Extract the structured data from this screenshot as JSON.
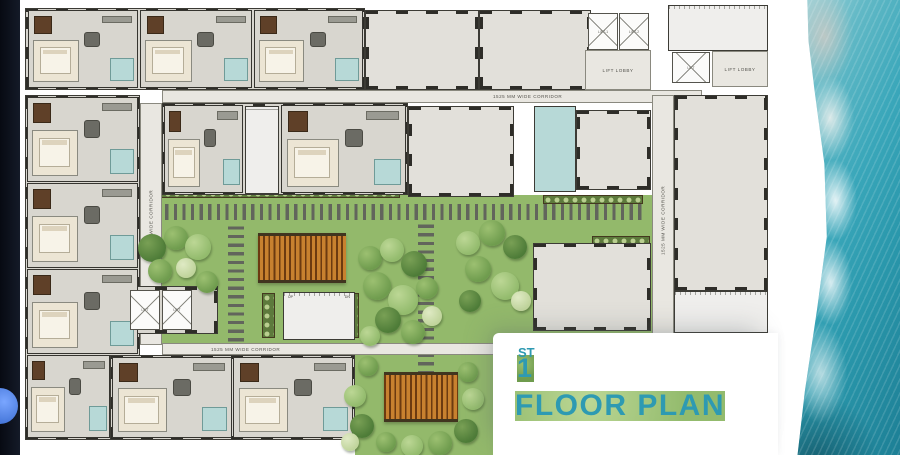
{
  "title": {
    "number": "1",
    "suffix": "ST",
    "label": "FLOOR PLAN",
    "color": "#2e9ab2"
  },
  "labels": {
    "corridor": "1525 MM WIDE CORRIDOR",
    "lift_lobby": "LIFT LOBBY",
    "lift1": "LIFT-1",
    "lift2": "LIFT-2",
    "lift": "LIFT",
    "up": "UP",
    "dn": "DN"
  },
  "colors": {
    "lawn": "#93b96b",
    "wall": "#35342f",
    "hall_floor": "#e2e0da",
    "unit_floor": "#d8d6cf",
    "corridor_floor": "#e9e7e1",
    "bath": "#b7d9d7",
    "bedroom": "#ece5d4",
    "kitchen": "#5f4028",
    "pergola": "#c8812f",
    "stone": "#62655c",
    "planter": "#5d7a3c",
    "ocean_teal": "#2a98ac",
    "title_teal": "#2e9ab2",
    "edge_strip": "#0b0f1a"
  },
  "plan": {
    "lawns": [
      {
        "x": 140,
        "y": 195,
        "w": 512,
        "h": 150
      },
      {
        "x": 355,
        "y": 353,
        "w": 157,
        "h": 102
      }
    ],
    "stones": [
      {
        "dir": "h",
        "x": 148,
        "y": 204,
        "w": 498,
        "h": 16
      },
      {
        "dir": "v",
        "x": 228,
        "y": 226,
        "w": 16,
        "h": 124
      },
      {
        "dir": "v",
        "x": 418,
        "y": 224,
        "w": 16,
        "h": 150
      }
    ],
    "planters": [
      {
        "x": 145,
        "y": 189,
        "w": 255,
        "h": 9
      },
      {
        "x": 543,
        "y": 195,
        "w": 100,
        "h": 9
      },
      {
        "x": 592,
        "y": 236,
        "w": 58,
        "h": 9
      },
      {
        "x": 198,
        "y": 288,
        "w": 17,
        "h": 45
      },
      {
        "x": 262,
        "y": 293,
        "w": 13,
        "h": 45
      },
      {
        "x": 346,
        "y": 293,
        "w": 13,
        "h": 45
      }
    ],
    "pergolas": [
      {
        "x": 258,
        "y": 233,
        "w": 88,
        "h": 50
      },
      {
        "x": 384,
        "y": 372,
        "w": 74,
        "h": 50
      }
    ],
    "zones": [
      {
        "name": "top-units-block",
        "cls": "zone floor walled",
        "x": 25,
        "y": 8,
        "w": 340,
        "h": 82
      },
      {
        "name": "hall-top-1",
        "cls": "zone hall walled",
        "x": 365,
        "y": 10,
        "w": 114,
        "h": 80
      },
      {
        "name": "hall-top-2",
        "cls": "zone hall walled",
        "x": 479,
        "y": 10,
        "w": 112,
        "h": 80
      },
      {
        "name": "lift-lobby-top",
        "cls": "zone corridor",
        "x": 585,
        "y": 50,
        "w": 66,
        "h": 40,
        "label": "lift_lobby"
      },
      {
        "name": "stair-top-right",
        "cls": "zone treads-v walled",
        "x": 668,
        "y": 5,
        "w": 100,
        "h": 46
      },
      {
        "name": "lift-lobby-top-right",
        "cls": "zone corridor",
        "x": 712,
        "y": 51,
        "w": 56,
        "h": 36,
        "label": "lift_lobby"
      },
      {
        "name": "corridor-top",
        "cls": "zone corridor",
        "x": 162,
        "y": 90,
        "w": 540,
        "h": 13,
        "label": "corridor",
        "lx": 330
      },
      {
        "name": "left-units-block",
        "cls": "zone floor walled",
        "x": 25,
        "y": 95,
        "w": 115,
        "h": 345
      },
      {
        "name": "corridor-left",
        "cls": "zone corridor vlabel",
        "x": 140,
        "y": 103,
        "w": 22,
        "h": 242,
        "label": "corridor"
      },
      {
        "name": "row2-units-block",
        "cls": "zone floor walled",
        "x": 162,
        "y": 103,
        "w": 246,
        "h": 92
      },
      {
        "name": "stair-row2",
        "cls": "zone treads-h walled",
        "x": 245,
        "y": 106,
        "w": 34,
        "h": 88
      },
      {
        "name": "hall-1",
        "cls": "zone hall walled",
        "x": 408,
        "y": 106,
        "w": 106,
        "h": 91
      },
      {
        "name": "toilets",
        "cls": "zone bathz",
        "x": 534,
        "y": 106,
        "w": 42,
        "h": 86
      },
      {
        "name": "hall-2",
        "cls": "zone hall walled",
        "x": 576,
        "y": 110,
        "w": 75,
        "h": 80
      },
      {
        "name": "hall-3",
        "cls": "zone hall walled",
        "x": 533,
        "y": 243,
        "w": 118,
        "h": 88
      },
      {
        "name": "corridor-right",
        "cls": "zone corridor vlabel",
        "x": 652,
        "y": 95,
        "w": 22,
        "h": 250,
        "label": "corridor"
      },
      {
        "name": "hall-4",
        "cls": "zone hall walled",
        "x": 674,
        "y": 95,
        "w": 94,
        "h": 196
      },
      {
        "name": "stair-bottom-right",
        "cls": "zone treads-v walled",
        "x": 674,
        "y": 291,
        "w": 94,
        "h": 42
      },
      {
        "name": "corridor-bottom",
        "cls": "zone corridor",
        "x": 162,
        "y": 343,
        "w": 350,
        "h": 12,
        "label": "corridor",
        "lx": 48
      },
      {
        "name": "bottom-units-block",
        "cls": "zone floor walled",
        "x": 110,
        "y": 355,
        "w": 245,
        "h": 85
      },
      {
        "name": "lift-block-mid",
        "cls": "zone floor walled",
        "x": 124,
        "y": 286,
        "w": 94,
        "h": 48
      },
      {
        "name": "stair-central",
        "cls": "zone treads-v walled",
        "x": 283,
        "y": 292,
        "w": 72,
        "h": 48,
        "stair_tags": true
      }
    ],
    "lifts": [
      {
        "x": 588,
        "y": 13,
        "w": 30,
        "h": 37,
        "label": "lift1"
      },
      {
        "x": 619,
        "y": 13,
        "w": 30,
        "h": 37,
        "label": "lift2"
      },
      {
        "x": 672,
        "y": 52,
        "w": 38,
        "h": 31,
        "label": "lift"
      },
      {
        "x": 130,
        "y": 290,
        "w": 30,
        "h": 40,
        "label": "lift"
      },
      {
        "x": 162,
        "y": 290,
        "w": 30,
        "h": 40,
        "label": "lift"
      }
    ],
    "units": [
      {
        "x": 28,
        "y": 10,
        "w": 110,
        "h": 78
      },
      {
        "x": 140,
        "y": 10,
        "w": 112,
        "h": 78
      },
      {
        "x": 254,
        "y": 10,
        "w": 109,
        "h": 78
      },
      {
        "x": 27,
        "y": 97,
        "w": 111,
        "h": 85
      },
      {
        "x": 27,
        "y": 183,
        "w": 111,
        "h": 85
      },
      {
        "x": 27,
        "y": 269,
        "w": 111,
        "h": 85
      },
      {
        "x": 27,
        "y": 355,
        "w": 83,
        "h": 83
      },
      {
        "x": 164,
        "y": 105,
        "w": 79,
        "h": 88
      },
      {
        "x": 281,
        "y": 105,
        "w": 125,
        "h": 88
      },
      {
        "x": 112,
        "y": 357,
        "w": 120,
        "h": 81
      },
      {
        "x": 233,
        "y": 357,
        "w": 120,
        "h": 81
      }
    ],
    "trees": [
      [
        152,
        248,
        14,
        0
      ],
      [
        176,
        238,
        12,
        1
      ],
      [
        198,
        247,
        13,
        2
      ],
      [
        160,
        271,
        12,
        1
      ],
      [
        186,
        268,
        10,
        3
      ],
      [
        207,
        282,
        11,
        1
      ],
      [
        370,
        258,
        12,
        1
      ],
      [
        392,
        250,
        12,
        2
      ],
      [
        414,
        264,
        13,
        0
      ],
      [
        377,
        286,
        14,
        1
      ],
      [
        403,
        300,
        15,
        2
      ],
      [
        427,
        288,
        11,
        1
      ],
      [
        388,
        320,
        13,
        0
      ],
      [
        413,
        332,
        12,
        1
      ],
      [
        370,
        336,
        10,
        2
      ],
      [
        432,
        316,
        10,
        3
      ],
      [
        468,
        243,
        12,
        2
      ],
      [
        492,
        233,
        13,
        1
      ],
      [
        515,
        247,
        12,
        0
      ],
      [
        478,
        269,
        13,
        1
      ],
      [
        505,
        286,
        14,
        2
      ],
      [
        470,
        301,
        11,
        0
      ],
      [
        521,
        301,
        10,
        3
      ],
      [
        368,
        366,
        10,
        1
      ],
      [
        355,
        396,
        11,
        2
      ],
      [
        362,
        426,
        12,
        0
      ],
      [
        386,
        442,
        10,
        1
      ],
      [
        412,
        446,
        11,
        2
      ],
      [
        440,
        443,
        12,
        1
      ],
      [
        466,
        431,
        12,
        0
      ],
      [
        473,
        399,
        11,
        2
      ],
      [
        468,
        372,
        10,
        1
      ],
      [
        350,
        442,
        9,
        3
      ]
    ]
  }
}
